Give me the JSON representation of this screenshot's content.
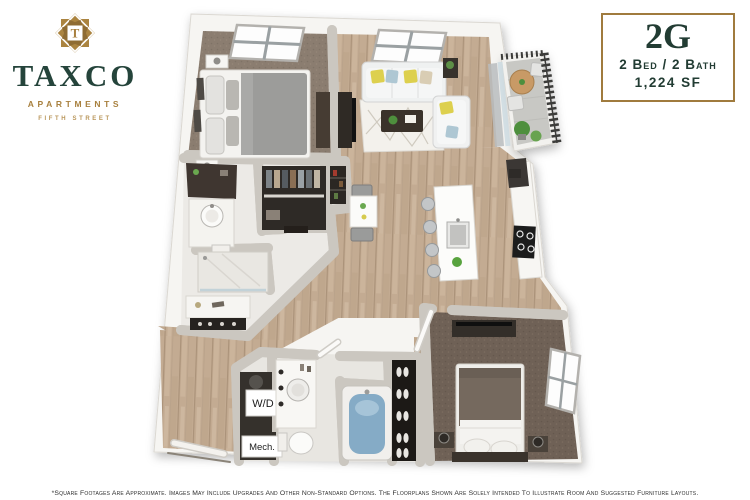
{
  "brand": {
    "emblem_letter": "T",
    "name": "TAXCO",
    "type": "APARTMENTS",
    "location": "FIFTH STREET"
  },
  "unit_card": {
    "unit_label": "2G",
    "specs": "2 Bed / 2 Bath",
    "area": "1,224 SF"
  },
  "floorplan": {
    "labels": {
      "washer_dryer": "W/D",
      "mechanical": "Mech."
    },
    "rooms": [
      "bedroom-1",
      "living-room",
      "dining-nook",
      "kitchen",
      "bathroom-1",
      "walk-in-closet",
      "pantry",
      "entry",
      "laundry-closet",
      "mechanical-closet",
      "bathroom-2",
      "shoe-closet",
      "bedroom-2",
      "balcony"
    ]
  },
  "footnote": "*Square Footages Are Approximate. Images May Include Upgrades And Other Non-Standard Options. The Floorplans Shown Are Solely Intended To Illustrate Room And Suggested Furniture Layouts.",
  "colors": {
    "brand_green": "#25443b",
    "brand_gold": "#a8803e",
    "wood_floor": "#c3ab92",
    "carpet_bedroom_1": "#8b7d70",
    "carpet_bedroom_2": "#6f6156",
    "bath_tile": "#eceae6",
    "tub_water": "#85abc6",
    "balcony_floor": "#c8c8c4"
  }
}
